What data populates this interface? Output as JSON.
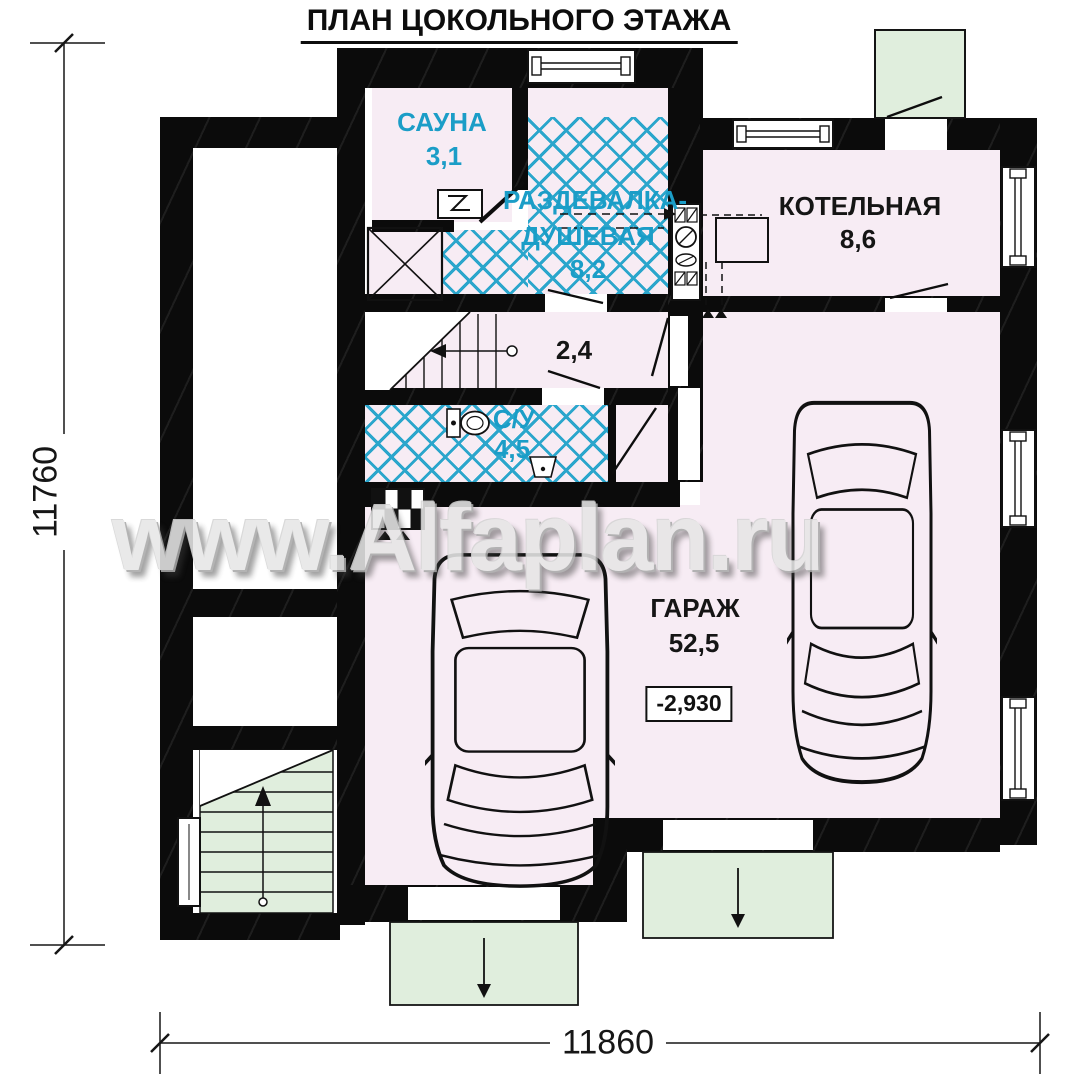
{
  "title": "ПЛАН ЦОКОЛЬНОГО ЭТАЖА",
  "watermark": "www.Alfaplan.ru",
  "dimensions": {
    "left_total": "11760",
    "bottom_total": "11860"
  },
  "rooms": {
    "sauna": {
      "name": "САУНА",
      "area": "3,1"
    },
    "dressing_shower": {
      "line1": "РАЗДЕВАЛКА-",
      "line2": "ДУШЕВАЯ",
      "area": "8,2"
    },
    "boiler_room": {
      "name": "КОТЕЛЬНАЯ",
      "area": "8,6"
    },
    "hallway": {
      "area": "2,4"
    },
    "bathroom": {
      "name": "С/У",
      "area": "4,5"
    },
    "garage": {
      "name": "ГАРАЖ",
      "area": "52,5",
      "elevation": "-2,930"
    }
  },
  "colors": {
    "room_fill": "#f7ecf4",
    "exterior_green": "#e0eedd",
    "tile_cyan": "#2ba6cc",
    "label_cyan": "#1b9dc7",
    "wall_black": "#0b0b0b",
    "watermark_grey": "#e6e6e6"
  }
}
